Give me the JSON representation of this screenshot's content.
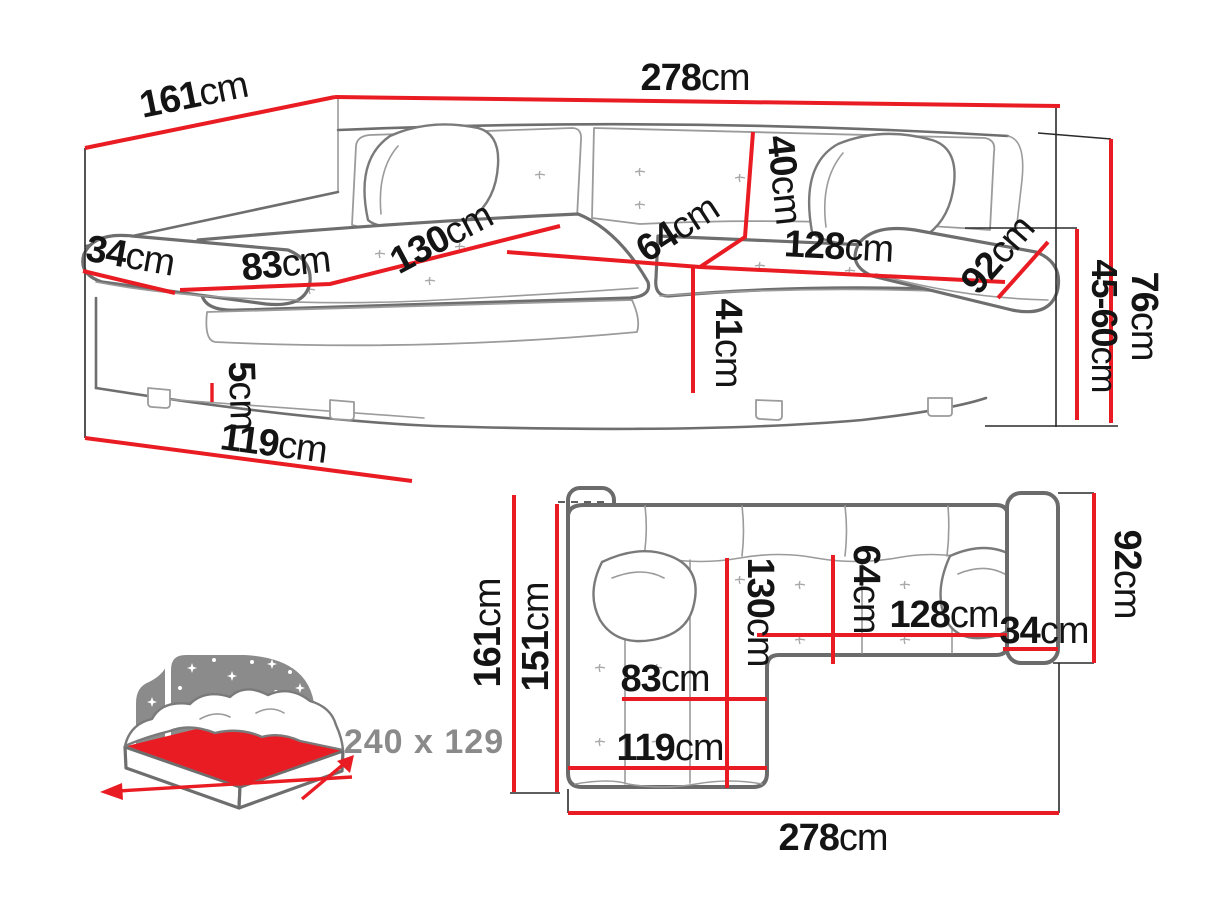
{
  "document": {
    "type": "corner-sofa dimension diagram",
    "views": [
      "perspective view",
      "top-down plan view",
      "sleeping-area icon"
    ]
  },
  "colors": {
    "dimension_red": "#ea1c23",
    "sketch_gray": "#6e6e6e",
    "detail_gray": "#9b9b9b",
    "label_black": "#141414",
    "muted_gray": "#8a8a8a"
  },
  "perspective": {
    "dims": {
      "w161": {
        "value": "161",
        "unit": "cm"
      },
      "w278": {
        "value": "278",
        "unit": "cm"
      },
      "a34": {
        "value": "34",
        "unit": "cm"
      },
      "c83": {
        "value": "83",
        "unit": "cm"
      },
      "c130": {
        "value": "130",
        "unit": "cm"
      },
      "h40": {
        "value": "40",
        "unit": "cm"
      },
      "d64": {
        "value": "64",
        "unit": "cm"
      },
      "w128": {
        "value": "128",
        "unit": "cm"
      },
      "a92": {
        "value": "92",
        "unit": "cm"
      },
      "h41": {
        "value": "41",
        "unit": "cm"
      },
      "h76": {
        "value": "76",
        "unit": "cm"
      },
      "h45_60": {
        "value": "45-60",
        "unit": "cm"
      },
      "h5": {
        "value": "5",
        "unit": "cm"
      },
      "w119": {
        "value": "119",
        "unit": "cm"
      }
    }
  },
  "top_down": {
    "dims": {
      "d161": {
        "value": "161",
        "unit": "cm"
      },
      "d151": {
        "value": "151",
        "unit": "cm"
      },
      "c130": {
        "value": "130",
        "unit": "cm"
      },
      "d64": {
        "value": "64",
        "unit": "cm"
      },
      "w128": {
        "value": "128",
        "unit": "cm"
      },
      "a34": {
        "value": "34",
        "unit": "cm"
      },
      "a92": {
        "value": "92",
        "unit": "cm"
      },
      "c83": {
        "value": "83",
        "unit": "cm"
      },
      "w119": {
        "value": "119",
        "unit": "cm"
      },
      "w278": {
        "value": "278",
        "unit": "cm"
      }
    }
  },
  "sleeping_function": {
    "icon": "bed-night-icon",
    "dimensions_label": "240 x 129"
  }
}
